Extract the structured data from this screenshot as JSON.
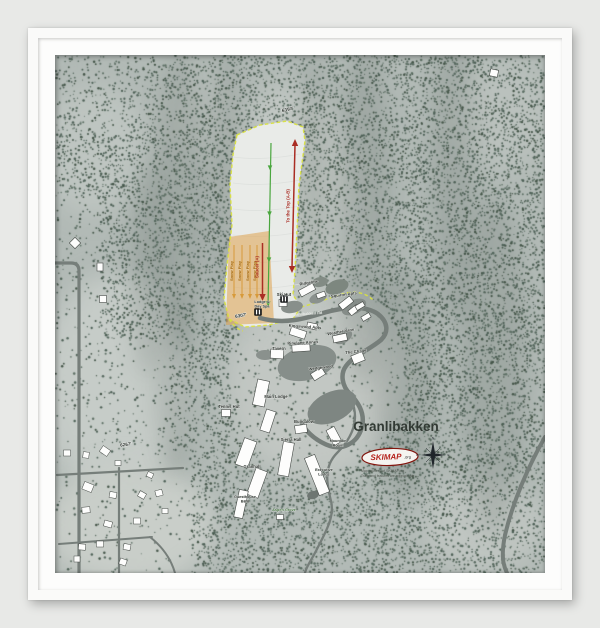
{
  "frame": {
    "bg": "#e8e9e7",
    "frame_color": "#fafaf9",
    "mat_color": "#fdfdfc"
  },
  "map": {
    "title": "Granlibakken",
    "logo": {
      "brand": "SKIMAP",
      "tld": ".org"
    },
    "fineprint": [
      "Map courtesy of SKIMAP.org",
      "Trails and features are approximate"
    ],
    "compass": {
      "n": "N",
      "e": "E",
      "s": "S",
      "w": "W"
    },
    "colors": {
      "terrain_base": "#b2bab6",
      "slope_fill": "#e9ebe8",
      "boundary_yellow": "#d9e23f",
      "trail_green": "#4aa63e",
      "lift_red": "#aa2d24",
      "snowplay_fill": "#dfa24f",
      "snowplay_line": "#d79a3a",
      "snowplay_text": "#a86d12",
      "road_gray": "#767e7a",
      "building_fill": "#fdfdfc",
      "label_dark": "#2c322d",
      "title_color": "#323a34",
      "logo_red": "#b5221c"
    },
    "snow_play": {
      "label": "Snow Play"
    },
    "lifts": [
      {
        "label": "To the Top (A-B)",
        "x1": 240,
        "y1": 90,
        "x2": 237,
        "y2": 212,
        "arrows": "both",
        "lx": 234.5,
        "ly": 151
      },
      {
        "label": "Saucer (A)",
        "x1": 207.5,
        "y1": 188,
        "x2": 207.5,
        "y2": 240,
        "arrows": "down",
        "lx": 203.5,
        "ly": 212
      }
    ],
    "labels": [
      {
        "t": "6397'",
        "x": 233,
        "y": 56,
        "r": -14,
        "s": 4.8,
        "cls": "elev"
      },
      {
        "t": "6307'",
        "x": 186,
        "y": 262,
        "r": -10,
        "s": 4.6,
        "cls": "elev"
      },
      {
        "t": "6267'",
        "x": 71,
        "y": 391,
        "r": -8,
        "s": 4.6,
        "cls": "elev"
      },
      {
        "t": "Ridgeline",
        "x": 254,
        "y": 229,
        "r": -10
      },
      {
        "t": "Squirrel Apts",
        "x": 289,
        "y": 241,
        "r": -8
      },
      {
        "t": "Ski Hut",
        "x": 229,
        "y": 241
      },
      {
        "t": "Lodge &",
        "x": 207,
        "y": 248,
        "s": 3.8
      },
      {
        "t": "Day Spa",
        "x": 207,
        "y": 252.5,
        "s": 3.8
      },
      {
        "t": "Granlibakken Rd",
        "x": 252,
        "y": 260,
        "r": -4,
        "s": 3.9,
        "c": "#e6e9e5",
        "cls": "road"
      },
      {
        "t": "Kingswood Apts",
        "x": 250,
        "y": 273,
        "r": 4
      },
      {
        "t": "Weather Vane",
        "x": 286,
        "y": 278,
        "r": -10
      },
      {
        "t": "Pinelane Annex",
        "x": 248,
        "y": 289,
        "r": -3
      },
      {
        "t": "Tavern",
        "x": 224,
        "y": 295
      },
      {
        "t": "The Chalet",
        "x": 301,
        "y": 298,
        "r": -6
      },
      {
        "t": "Wedgewood",
        "x": 266,
        "y": 314,
        "r": -8
      },
      {
        "t": "Main Lodge",
        "x": 221,
        "y": 343
      },
      {
        "t": "Tennis Hut",
        "x": 174,
        "y": 353
      },
      {
        "t": "Bungalow",
        "x": 249,
        "y": 368
      },
      {
        "t": "Sierra Hall",
        "x": 236,
        "y": 386
      },
      {
        "t": "Mountain",
        "x": 283,
        "y": 387,
        "s": 3.8
      },
      {
        "t": "Room",
        "x": 283,
        "y": 391.5,
        "s": 3.8
      },
      {
        "t": "Granhall",
        "x": 197,
        "y": 413
      },
      {
        "t": "Executive",
        "x": 269,
        "y": 416,
        "s": 3.8
      },
      {
        "t": "Lodge",
        "x": 269,
        "y": 420.5,
        "s": 3.8
      },
      {
        "t": "Guesthouse",
        "x": 190,
        "y": 443,
        "s": 3.8
      },
      {
        "t": "B&B",
        "x": 190,
        "y": 447.5,
        "s": 3.8
      },
      {
        "t": "Aspen Grove",
        "x": 229,
        "y": 456,
        "s": 3.8,
        "c": "#3e6b39"
      }
    ],
    "geometry": {
      "slope_points": "182,80 205,70 232,66 248,72 250,86 244,130 242,175 240,215 238,240 246,252 238,264 214,270 190,272 174,264 169,244 172,210 177,170 175,130 178,100",
      "boundary_tails": [
        "M246,252 C258,249 272,244 284,240 C298,235 310,237 318,245",
        "M174,264 C178,270 182,274 188,276"
      ],
      "trail": {
        "d": "M216,88 C215,130 214,180 213,252",
        "arrows": [
          [
            215,
            112
          ],
          [
            214.5,
            158
          ],
          [
            214,
            204
          ],
          [
            213.2,
            248
          ]
        ]
      },
      "snowplay": {
        "points": "174,182 214,176 219,268 171,270",
        "line_xs": [
          179,
          187,
          195,
          202
        ],
        "line_y1": 190,
        "line_y2": 240,
        "label_xs": [
          178,
          186,
          194,
          201
        ],
        "label_y": 216
      },
      "roads": [
        {
          "d": "M205,263 C230,270 252,263 268,258 C292,251 312,251 323,259 C333,267 334,277 326,285 C314,295 298,301 291,311 C285,319 287,331 295,339 C305,349 311,361 306,375 C301,389 287,395 275,391 C263,387 252,378 247,369",
          "w": 4.5
        },
        {
          "d": "M296,344 C306,366 296,384 282,398 C268,412 272,430 276,446 C280,462 270,478 262,494 C256,506 251,512 250,518",
          "w": 2.3
        },
        {
          "d": "M0,208 H16 Q24,208 24,216 V518",
          "w": 3.2
        },
        {
          "d": "M2,420 L128,413",
          "w": 2.2
        },
        {
          "d": "M64,413 V518",
          "w": 2.2
        },
        {
          "d": "M4,489 L97,482",
          "w": 2
        },
        {
          "d": "M95,482 Q114,497 120,518",
          "w": 2
        },
        {
          "d": "M490,382 C474,410 458,446 450,480 C446,500 448,510 452,518",
          "w": 4
        }
      ],
      "blobs": [
        [
          252,
          308,
          30,
          17,
          -15,
          "#868e8a"
        ],
        [
          277,
          352,
          26,
          15,
          -25,
          "#7e8682"
        ],
        [
          237,
          252,
          11,
          6,
          -10,
          "#888f8b"
        ],
        [
          263,
          243,
          9,
          5,
          -20,
          "#8a918d"
        ],
        [
          299,
          252,
          13,
          7,
          -25,
          "#858c88"
        ],
        [
          210,
          300,
          9,
          5,
          0,
          "#8a918d"
        ],
        [
          258,
          440,
          6,
          4,
          -15,
          "#6e7672"
        ],
        [
          288,
          282,
          10,
          6,
          -30,
          "#868d89"
        ],
        [
          282,
          232,
          12,
          7,
          -20,
          "#7d877f"
        ],
        [
          265,
          227,
          8,
          5,
          -10,
          "#828b84"
        ]
      ],
      "buildings": [
        [
          252,
          235,
          16,
          7,
          -28
        ],
        [
          266,
          240,
          9,
          5,
          -20
        ],
        [
          291,
          248,
          14,
          7,
          -38
        ],
        [
          299,
          255,
          11,
          6,
          -38
        ],
        [
          228,
          248,
          8,
          7,
          0
        ],
        [
          243,
          278,
          16,
          8,
          18
        ],
        [
          257,
          271,
          10,
          6,
          12
        ],
        [
          285,
          283,
          14,
          7,
          -12
        ],
        [
          246,
          293,
          18,
          7,
          -4
        ],
        [
          222,
          299,
          13,
          9,
          4
        ],
        [
          303,
          303,
          12,
          9,
          -22
        ],
        [
          263,
          319,
          13,
          8,
          -32
        ],
        [
          206,
          338,
          12,
          26,
          12
        ],
        [
          213,
          366,
          10,
          22,
          18
        ],
        [
          171,
          358,
          9,
          7,
          0
        ],
        [
          246,
          374,
          12,
          8,
          -8
        ],
        [
          191,
          398,
          13,
          28,
          20
        ],
        [
          202,
          428,
          12,
          28,
          20
        ],
        [
          231,
          404,
          11,
          34,
          10
        ],
        [
          279,
          381,
          9,
          17,
          -28
        ],
        [
          262,
          420,
          11,
          40,
          -22
        ],
        [
          186,
          449,
          9,
          28,
          12
        ],
        [
          439,
          18,
          8,
          7,
          12
        ],
        [
          311,
          262,
          9,
          5,
          -30
        ],
        [
          305,
          251,
          9,
          5,
          -30
        ],
        [
          20,
          188,
          8,
          8,
          45
        ],
        [
          45,
          212,
          6,
          8,
          0
        ],
        [
          48,
          244,
          7,
          7,
          0
        ],
        [
          225,
          462,
          7,
          5,
          0
        ]
      ],
      "houses": [
        [
          12,
          398,
          7,
          6,
          0
        ],
        [
          31,
          400,
          6,
          6,
          8
        ],
        [
          50,
          396,
          9,
          7,
          35
        ],
        [
          63,
          408,
          6,
          5,
          0
        ],
        [
          33,
          432,
          10,
          8,
          22
        ],
        [
          58,
          440,
          7,
          6,
          10
        ],
        [
          31,
          455,
          8,
          6,
          -5
        ],
        [
          53,
          469,
          8,
          6,
          15
        ],
        [
          27,
          492,
          7,
          6,
          5
        ],
        [
          45,
          489,
          7,
          6,
          0
        ],
        [
          22,
          504,
          6,
          6,
          0
        ],
        [
          68,
          507,
          7,
          6,
          20
        ],
        [
          87,
          440,
          7,
          6,
          30
        ],
        [
          82,
          466,
          7,
          6,
          0
        ],
        [
          72,
          492,
          7,
          6,
          10
        ],
        [
          104,
          438,
          7,
          6,
          -15
        ],
        [
          110,
          456,
          6,
          5,
          0
        ],
        [
          95,
          420,
          6,
          5,
          25
        ]
      ],
      "facility_icons": [
        {
          "x": 203,
          "y": 257
        },
        {
          "x": 229,
          "y": 244
        }
      ]
    }
  }
}
